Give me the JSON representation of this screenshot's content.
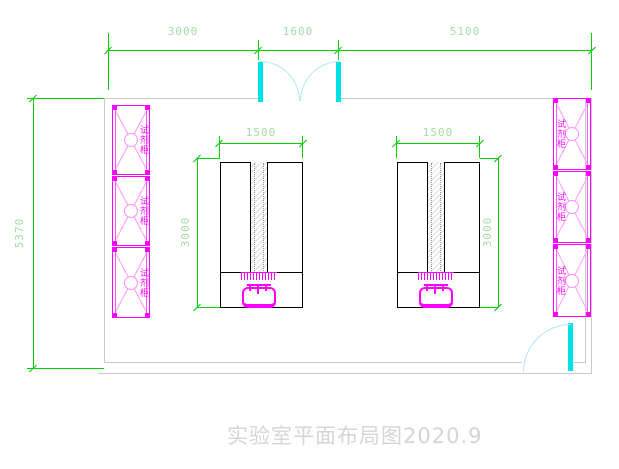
{
  "drawing": {
    "title": "实验室平面布局图2020.9"
  },
  "dims": {
    "top_left": "3000",
    "top_mid": "1600",
    "top_right": "5100",
    "wall_height": "5370",
    "bench_width": "1500",
    "bench_depth": "3000"
  },
  "cabinet": {
    "label": "试剂柜"
  },
  "colors": {
    "dimension_line": "#00d400",
    "dimension_text": "#a4dba4",
    "cabinet": "#ff00ff",
    "door": "#00e2ea",
    "wall": "#cbcbcb",
    "bench": "#000000",
    "title_text": "#d5d5d5"
  }
}
